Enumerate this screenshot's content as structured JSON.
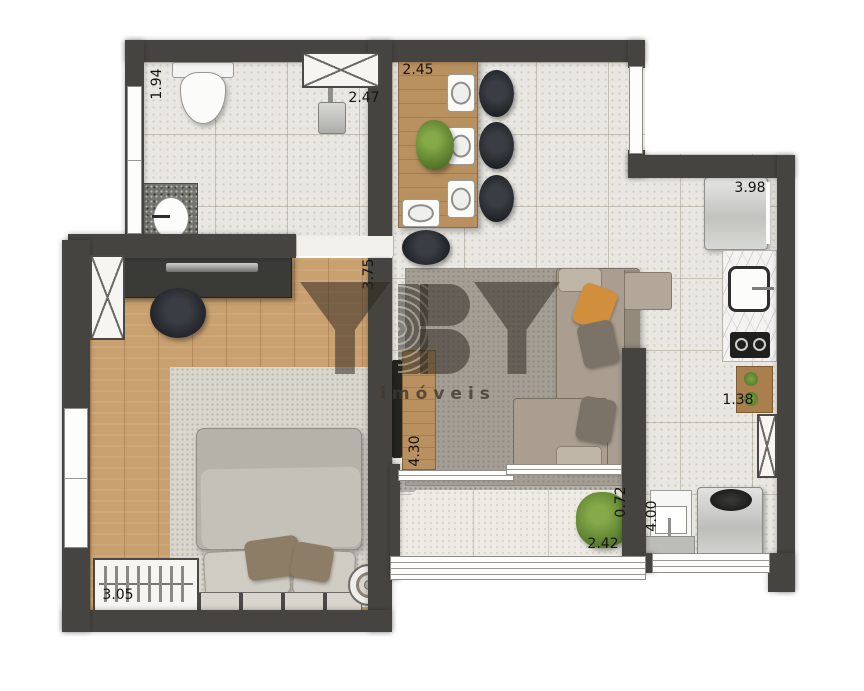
{
  "watermark": {
    "brand": "YBY",
    "tagline": "imóveis"
  },
  "dimensions": {
    "bathroom_side": "1.94",
    "bathroom_top": "2.47",
    "dining_top": "2.45",
    "kitchen_top": "3.98",
    "bedroom_side": "3.75",
    "kitchen_side": "1.38",
    "living_side": "4.30",
    "balcony_side": "0.72",
    "balcony_bottom": "2.42",
    "laundry_side": "4.00",
    "bedroom_bottom": "3.05"
  },
  "colors": {
    "wall": "#454440",
    "tile_floor": "#e9e7e1",
    "wood_floor": "#c9a06f",
    "accent_pillow": "#d18f3e",
    "plant_green": "#6b9038"
  }
}
